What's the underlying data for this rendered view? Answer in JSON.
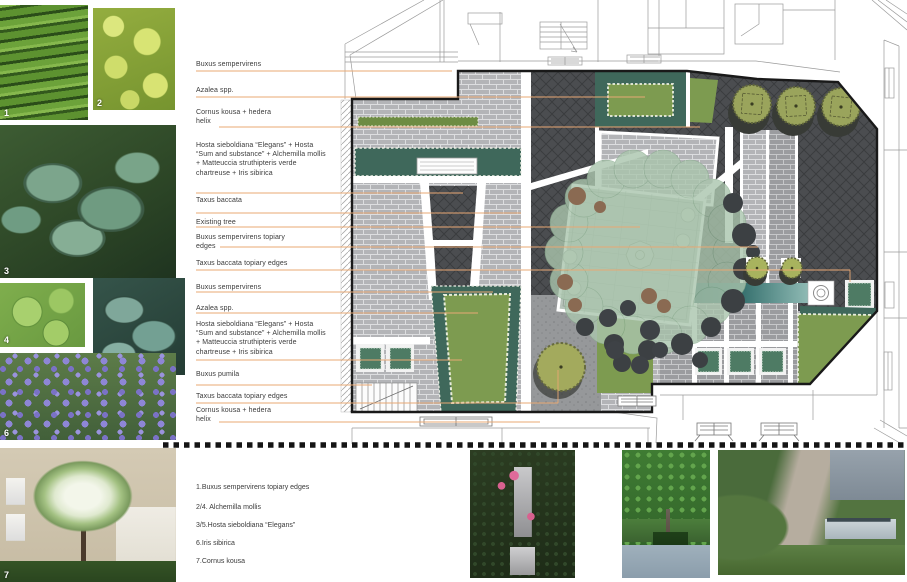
{
  "plant_labels": [
    {
      "text": "Buxus sempervirens"
    },
    {
      "text": "Azalea spp."
    },
    {
      "text": "Cornus kousa + hedera helix"
    },
    {
      "text": "Hosta sieboldiana “Elegans” + Hosta “Sum and substance” + Alchemilla mollis + Matteuccia struthipteris verde chartreuse + Iris sibirica"
    },
    {
      "text": "Taxus baccata"
    },
    {
      "text": "Existing tree"
    },
    {
      "text": "Buxus sempervirens topiary edges"
    },
    {
      "text": "Taxus baccata topiary edges"
    },
    {
      "text": "Buxus sempervirens"
    },
    {
      "text": "Azalea spp."
    },
    {
      "text": "Hosta sieboldiana “Elegans” + Hosta “Sum and substance” + Alchemilla mollis + Matteuccia struthipteris verde chartreuse + Iris sibirica"
    },
    {
      "text": "Buxus pumila"
    },
    {
      "text": "Taxus baccata topiary edges"
    },
    {
      "text": "Cornus kousa + hedera helix"
    }
  ],
  "legend": {
    "items": [
      "1.Buxus sempervirens topiary edges",
      "2/4. Alchemilla mollis",
      "3/5.Hosta sieboldiana “Elegans”",
      "6.Iris sibirica",
      "7.Cornus kousa"
    ]
  },
  "photos": [
    {
      "number": "1"
    },
    {
      "number": "2"
    },
    {
      "number": "3"
    },
    {
      "number": "4"
    },
    {
      "number": "5"
    },
    {
      "number": "6"
    },
    {
      "number": "7"
    }
  ],
  "colors": {
    "leader_line": "#E8A873",
    "lawn_green": "#7D9B50",
    "hedge_teal": "#3F685B",
    "canopy_sage": "#AAC5AD",
    "water_teal": "#12383C",
    "paver_light": "#B3B4B7",
    "herringbone_dark": "#4B4D50",
    "label_text": "#3B3B3B"
  }
}
